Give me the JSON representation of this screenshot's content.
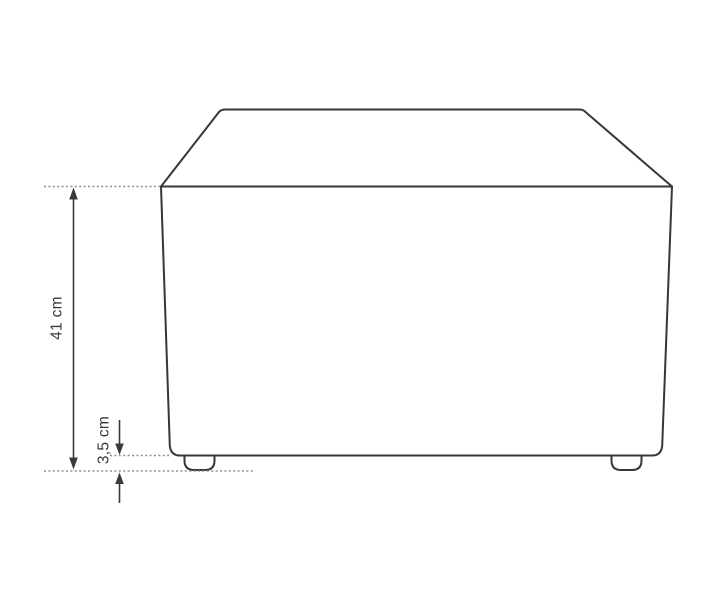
{
  "diagram": {
    "kind": "furniture-dimension-drawing",
    "colors": {
      "background": "#ffffff",
      "outline": "#373737",
      "dimension": "#3a3a3a",
      "extension": "#8f8f8f",
      "label": "#3a3a3a"
    },
    "dimensions": [
      {
        "id": "overall-height",
        "label": "41 cm"
      },
      {
        "id": "leg-height",
        "label": "3,5 cm"
      }
    ]
  }
}
